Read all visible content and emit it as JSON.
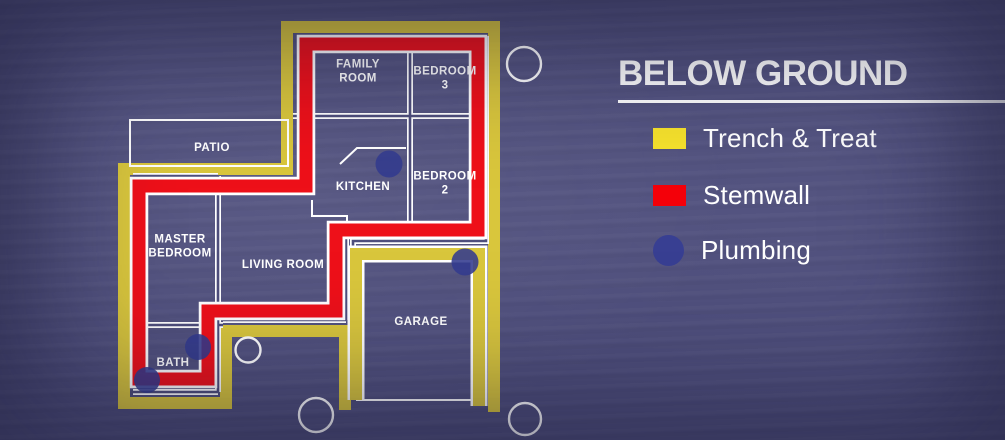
{
  "legend": {
    "title": "BELOW GROUND",
    "items": [
      {
        "label": "Trench & Treat",
        "color": "#f6e22c",
        "shape": "rect"
      },
      {
        "label": "Stemwall",
        "color": "#f40009",
        "shape": "rect"
      },
      {
        "label": "Plumbing",
        "color": "#383f92",
        "shape": "circle"
      }
    ]
  },
  "plan": {
    "rooms": [
      {
        "name": "FAMILY\nROOM",
        "x": 358,
        "y": 72
      },
      {
        "name": "BEDROOM\n3",
        "x": 445,
        "y": 79
      },
      {
        "name": "PATIO",
        "x": 212,
        "y": 148
      },
      {
        "name": "KITCHEN",
        "x": 363,
        "y": 187
      },
      {
        "name": "BEDROOM\n2",
        "x": 445,
        "y": 184
      },
      {
        "name": "MASTER\nBEDROOM",
        "x": 180,
        "y": 247
      },
      {
        "name": "LIVING ROOM",
        "x": 283,
        "y": 265
      },
      {
        "name": "GARAGE",
        "x": 421,
        "y": 322
      },
      {
        "name": "BATH",
        "x": 173,
        "y": 363
      }
    ],
    "plumbing_markers": [
      {
        "x": 389,
        "y": 164,
        "r": 13.5
      },
      {
        "x": 465,
        "y": 262,
        "r": 13.5
      },
      {
        "x": 198,
        "y": 347,
        "r": 13
      },
      {
        "x": 147,
        "y": 380,
        "r": 13
      }
    ],
    "site_circles": [
      {
        "x": 524,
        "y": 64,
        "r": 17
      },
      {
        "x": 248,
        "y": 350,
        "r": 12.5
      },
      {
        "x": 316,
        "y": 415,
        "r": 17
      },
      {
        "x": 525,
        "y": 419,
        "r": 16
      }
    ]
  },
  "colors": {
    "background": "#4e4e7c",
    "trench_yellow": "#d9c63c",
    "stemwall_red": "#ee1019",
    "plumbing_blue": "#333b90",
    "wall_white": "#ffffff"
  }
}
